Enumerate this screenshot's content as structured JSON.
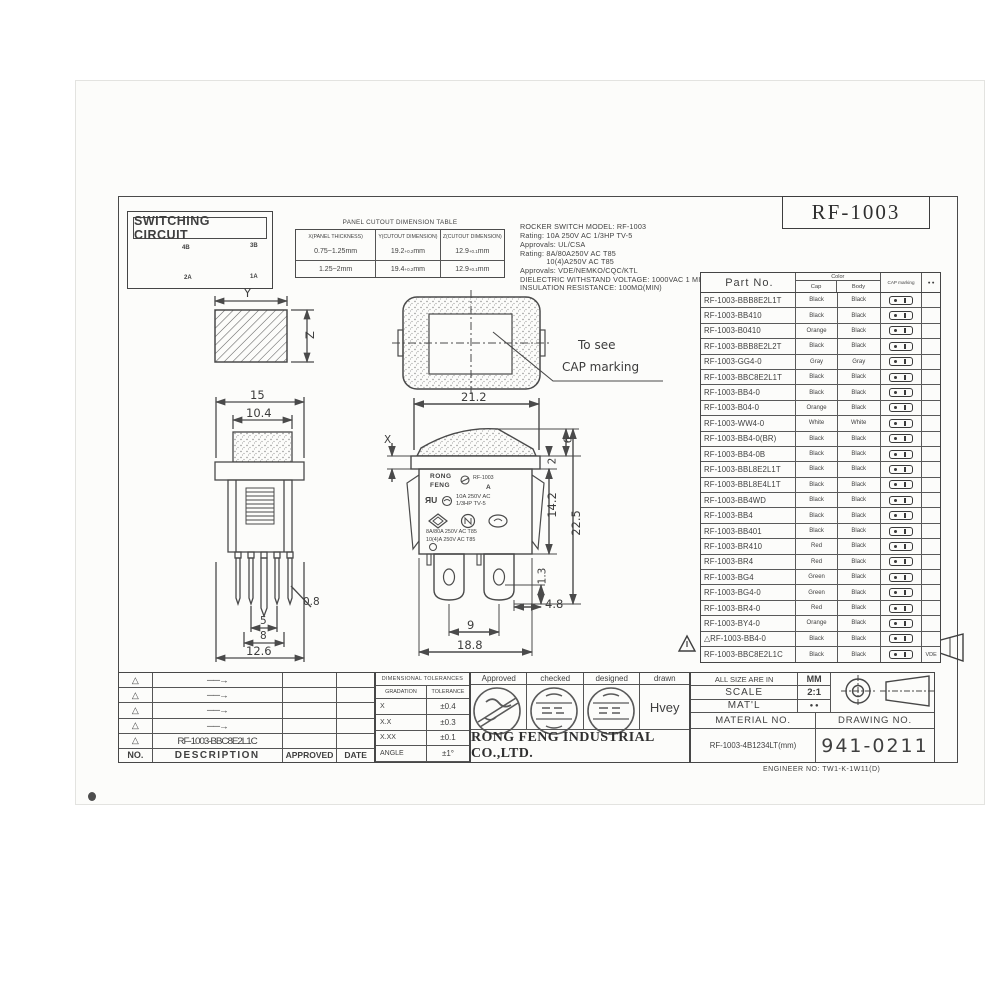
{
  "colors": {
    "ink": "#3c3c3c",
    "line": "#4a4a4a",
    "paper": "#fcfcfa"
  },
  "title_box": {
    "model": "RF-1003"
  },
  "switching_circuit": {
    "title": "SWITCHING CIRCUIT",
    "t_top_left": "4B",
    "t_top_right": "3B",
    "t_bot_left": "2A",
    "t_bot_right": "1A"
  },
  "cutout_table": {
    "title": "PANEL CUTOUT DIMENSION TABLE",
    "h1": "X(PANEL THICKNESS)",
    "h2": "Y(CUTOUT DIMENSION)",
    "h3": "Z(CUTOUT DIMENSION)",
    "rows": [
      {
        "x": "0.75~1.25mm",
        "y": "19.2",
        "ytol": "+0.2",
        "yunit": " mm",
        "z": "12.9",
        "ztol": "+0.1",
        "zunit": "mm"
      },
      {
        "x": "1.25~2mm",
        "y": "19.4",
        "ytol": "+0.2",
        "yunit": " mm",
        "z": "12.9",
        "ztol": "+0.1",
        "zunit": "mm"
      }
    ]
  },
  "specs": {
    "lines": [
      {
        "t": "ROCKER SWITCH MODEL: RF-1003"
      },
      {
        "t": "Rating: 10A 250V AC 1/3HP TV-5"
      },
      {
        "t": "Approvals: UL/CSA"
      },
      {
        "t": "Rating: 8A/80A250V AC T85"
      },
      {
        "t": "            10(4)A250V AC T85"
      },
      {
        "t": "Approvals: VDE/NEMKO/CQC/KTL"
      },
      {
        "t": "DIELECTRIC WITHSTAND VOLTAGE: 1000VAC 1 MINUTE"
      },
      {
        "t": "INSULATION RESISTANCE: 100MΩ(MIN)"
      }
    ]
  },
  "parts_table": {
    "col_part": "Part No.",
    "col_color": "Color",
    "col_cap": "Cap",
    "col_body": "Body",
    "col_marking": "CAP marking",
    "col_extra": "● ●",
    "rows": [
      {
        "part": "RF-1003-BBB8E2L1T",
        "cap": "Black",
        "body": "Black",
        "note": ""
      },
      {
        "part": "RF-1003-BB410",
        "cap": "Black",
        "body": "Black",
        "note": ""
      },
      {
        "part": "RF-1003-B0410",
        "cap": "Orange",
        "body": "Black",
        "note": ""
      },
      {
        "part": "RF-1003-BBB8E2L2T",
        "cap": "Black",
        "body": "Black",
        "note": ""
      },
      {
        "part": "RF-1003-GG4-0",
        "cap": "Gray",
        "body": "Gray",
        "note": ""
      },
      {
        "part": "RF-1003-BBC8E2L1T",
        "cap": "Black",
        "body": "Black",
        "note": ""
      },
      {
        "part": "RF-1003-BB4-0",
        "cap": "Black",
        "body": "Black",
        "note": ""
      },
      {
        "part": "RF-1003-B04-0",
        "cap": "Orange",
        "body": "Black",
        "note": ""
      },
      {
        "part": "RF-1003-WW4-0",
        "cap": "White",
        "body": "White",
        "note": ""
      },
      {
        "part": "RF-1003-BB4-0(BR)",
        "cap": "Black",
        "body": "Black",
        "note": ""
      },
      {
        "part": "RF-1003-BB4-0B",
        "cap": "Black",
        "body": "Black",
        "note": ""
      },
      {
        "part": "RF-1003-BBL8E2L1T",
        "cap": "Black",
        "body": "Black",
        "note": ""
      },
      {
        "part": "RF-1003-BBL8E4L1T",
        "cap": "Black",
        "body": "Black",
        "note": ""
      },
      {
        "part": "RF-1003-BB4WD",
        "cap": "Black",
        "body": "Black",
        "note": ""
      },
      {
        "part": "RF-1003-BB4",
        "cap": "Black",
        "body": "Black",
        "note": ""
      },
      {
        "part": "RF-1003-BB401",
        "cap": "Black",
        "body": "Black",
        "note": ""
      },
      {
        "part": "RF-1003-BR410",
        "cap": "Red",
        "body": "Black",
        "note": ""
      },
      {
        "part": "RF-1003-BR4",
        "cap": "Red",
        "body": "Black",
        "note": ""
      },
      {
        "part": "RF-1003-BG4",
        "cap": "Green",
        "body": "Black",
        "note": ""
      },
      {
        "part": "RF-1003-BG4-0",
        "cap": "Green",
        "body": "Black",
        "note": ""
      },
      {
        "part": "RF-1003-BR4-0",
        "cap": "Red",
        "body": "Black",
        "note": ""
      },
      {
        "part": "RF-1003-BY4-0",
        "cap": "Orange",
        "body": "Black",
        "note": ""
      },
      {
        "part": "△RF-1003-BB4-0",
        "cap": "Black",
        "body": "Black",
        "note": ""
      },
      {
        "part": "RF-1003-BBC8E2L1C",
        "cap": "Black",
        "body": "Black",
        "note": "VDE"
      }
    ]
  },
  "dims_left": {
    "y": "Y",
    "z": "Z",
    "w15": "15",
    "w104": "10.4",
    "p08": "0.8",
    "p5": "5",
    "p8": "8",
    "p126": "12.6"
  },
  "dims_mid": {
    "w212": "21.2",
    "x": "X",
    "d2": "2",
    "d6": "6",
    "d142": "14.2",
    "d225": "22.5",
    "d13": "1.3",
    "d48": "4.8",
    "d9": "9",
    "d188": "18.8"
  },
  "cap_note": {
    "line1": "To  see",
    "line2": "CAP  marking"
  },
  "switch_face": {
    "brand1": "RONG",
    "brand2": "FENG",
    "model": "RF-1003",
    "a": "A",
    "ul": "ЯU",
    "r1": "10A 250V AC",
    "r2": "1/3HP TV-5",
    "r3": "8A/80A 250V AC T85",
    "r4": "10(4)A 250V AC T85"
  },
  "revision_table": {
    "rows": [
      {
        "no": "△",
        "desc": "──→"
      },
      {
        "no": "△",
        "desc": "──→"
      },
      {
        "no": "△",
        "desc": "──→"
      },
      {
        "no": "△",
        "desc": "──→"
      },
      {
        "no": "△",
        "desc": "RF-1003-BBC8E2L1C"
      }
    ],
    "h_no": "NO.",
    "h_desc": "DESCRIPTION",
    "h_app": "APPROVED",
    "h_date": "DATE"
  },
  "tolerance_table": {
    "title": "DIMENSIONAL TOLERANCES",
    "h1": "GRADATION",
    "h2": "TOLERANCE",
    "rows": [
      {
        "g": "X",
        "t": "±0.4"
      },
      {
        "g": "X.X",
        "t": "±0.3"
      },
      {
        "g": "X.XX",
        "t": "±0.1"
      },
      {
        "g": "ANGLE",
        "t": "±1°"
      }
    ]
  },
  "approval": {
    "approved": "Approved",
    "checked": "checked",
    "designed": "designed",
    "drawn": "drawn",
    "drawn_name": "Hvey",
    "company": "RONG FENG INDUSTRIAL CO.,LTD."
  },
  "info_block": {
    "size_label": "ALL SIZE ARE IN",
    "size_value": "MM",
    "scale_label": "SCALE",
    "scale_value": "2:1",
    "matl_label": "MAT'L",
    "matl_value": "● ●",
    "material_no_label": "MATERIAL NO.",
    "material_no": "RF-1003-4B1234LT(mm)",
    "drawing_no_label": "DRAWING NO.",
    "drawing_no": "941-0211",
    "engineer_no": "ENGINEER NO: TW1-K-1W11(D)"
  }
}
